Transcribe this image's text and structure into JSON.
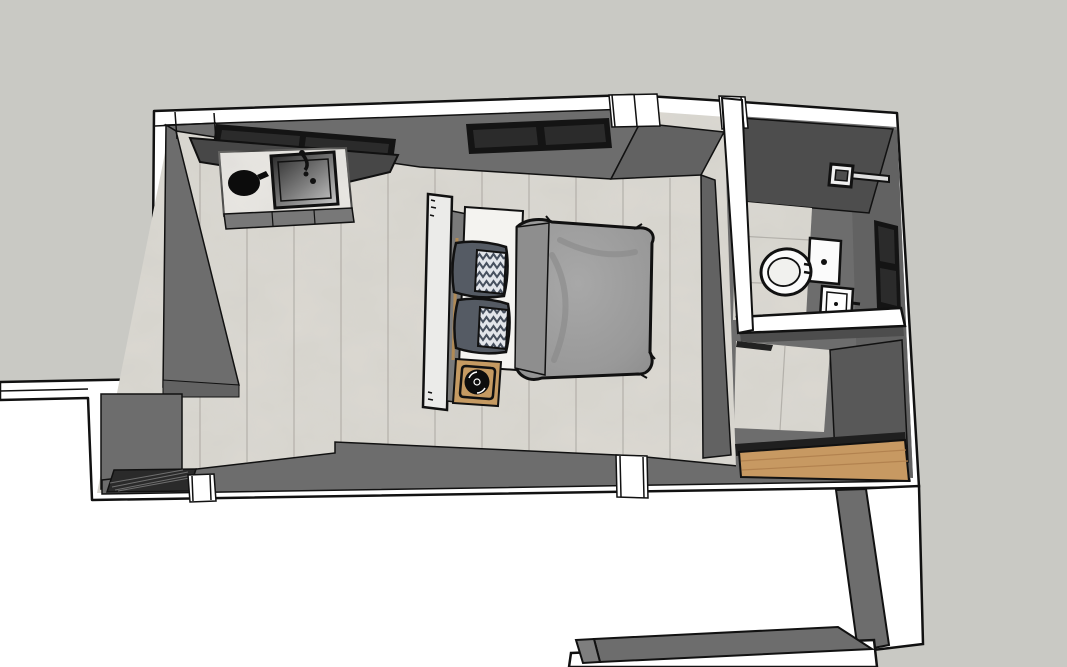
{
  "scene": {
    "label": "3D top-down view of a bedroom suite model with kitchenette, bed, bathroom and closet",
    "rooms": [
      {
        "name": "bedroom",
        "floor": "marble-tile"
      },
      {
        "name": "bathroom",
        "floor": "marble-tile"
      },
      {
        "name": "closet",
        "floor": "wood-plank"
      }
    ],
    "objects": [
      "kitchenette-counter",
      "kitchen-sink",
      "faucet",
      "black-pot",
      "range-hood-cabinet",
      "window-left",
      "window-center",
      "bathroom-window",
      "bed",
      "headboard",
      "mattress-sheet",
      "pillow-gray-pair",
      "pillow-chevron-pair",
      "duvet",
      "nightstand",
      "table-lamp",
      "floor-vent-grate",
      "toilet",
      "wall-basin",
      "towel-bar",
      "half-wall",
      "closet-wood-floor",
      "adjacent-exterior-wall"
    ]
  },
  "palette": {
    "background_gray": "#c9c9c4",
    "void_white": "#ffffff",
    "wall_white": "#ffffff",
    "wall_gray": "#6d6d6d",
    "wall_gray_mid": "#626262",
    "wall_gray_dark": "#4d4d4d",
    "wall_gray_deep": "#585858",
    "outline": "#111111",
    "floor_marble": "#dcd9d2",
    "floor_seam": "#b3b0aa",
    "counter_marble": "#eae8e4",
    "hood": "#474747",
    "window_frame": "#141414",
    "window_pane": "#2b2b2b",
    "wood": "#c79962",
    "wood_seam": "#b2824f",
    "threshold_dark": "#1f1f1f",
    "duvet": "#9b9b9b",
    "duvet_flap": "#8e8e8e",
    "pillow": "#555b64",
    "chevron_bg": "#e2e5ea",
    "chevron_stripe": "#47505e",
    "sheet": "#f4f3f0",
    "headboard": "#ebebe9",
    "headboard_panel": "#7a7a7a",
    "nightstand": "#c59a62",
    "lamp": "#0d0d0d",
    "fixture_white": "#fbfbfb",
    "grate": "#2a2a2a",
    "cabinet_front": "#787878"
  }
}
